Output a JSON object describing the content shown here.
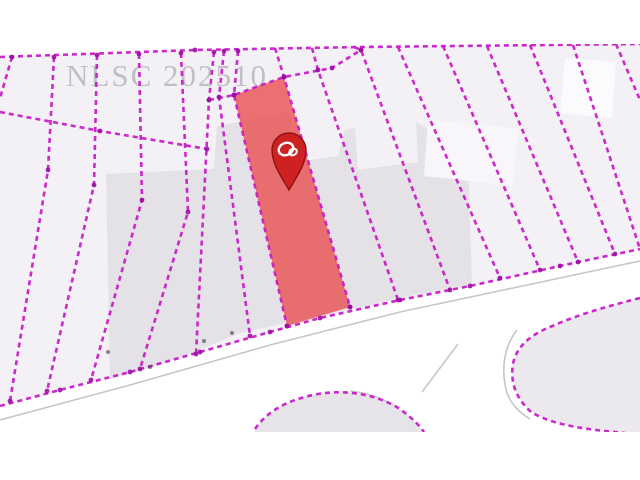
{
  "page": {
    "background": "#ffffff",
    "title": "Cadastral parcel map view"
  },
  "map": {
    "watermark": {
      "text": "NLSC 202510",
      "color": "#b7b5b9"
    },
    "colors": {
      "background": "#ffffff",
      "parcel_base_fill": "#f3f1f5",
      "parcel_gray_fill": "#e4e2e7",
      "road_edge": "#c7c5ca",
      "parcel_line": "#c81ec8",
      "vertex_dot": "#9a10a2",
      "highlight_fill": "#e94c4c",
      "pin_fill": "#ce2121",
      "pin_border": "#8e1111",
      "pin_logo": "#ffffff",
      "smudge": "#4a4350"
    },
    "area": {
      "left": 0,
      "top": 44,
      "right": 640,
      "bottom": 432
    },
    "line_style": {
      "width": 2.6,
      "dash": "5 4",
      "vertex_r": 2.4
    },
    "base_strip": [
      [
        0,
        57
      ],
      [
        195,
        50
      ],
      [
        360,
        47
      ],
      [
        640,
        44
      ],
      [
        640,
        249
      ],
      [
        560,
        266
      ],
      [
        470,
        286
      ],
      [
        400,
        300
      ],
      [
        320,
        318
      ],
      [
        270,
        332
      ],
      [
        200,
        352
      ],
      [
        130,
        372
      ],
      [
        60,
        390
      ],
      [
        0,
        406
      ]
    ],
    "gray_areas": [
      {
        "fill": "#e4e2e7",
        "points": [
          [
            106,
            174
          ],
          [
            214,
            169
          ],
          [
            217,
            126
          ],
          [
            290,
            112
          ],
          [
            292,
            163
          ],
          [
            338,
            156
          ],
          [
            345,
            130
          ],
          [
            355,
            128
          ],
          [
            358,
            170
          ],
          [
            418,
            162
          ],
          [
            416,
            122
          ],
          [
            448,
            140
          ],
          [
            468,
            158
          ],
          [
            472,
            284
          ],
          [
            400,
            298
          ],
          [
            320,
            316
          ],
          [
            240,
            333
          ],
          [
            196,
            351
          ],
          [
            160,
            365
          ],
          [
            110,
            379
          ]
        ]
      },
      {
        "fill": "#fbfafd",
        "points": [
          [
            565,
            58
          ],
          [
            616,
            62
          ],
          [
            612,
            118
          ],
          [
            560,
            113
          ]
        ]
      },
      {
        "fill": "#f8f6fa",
        "points": [
          [
            428,
            120
          ],
          [
            518,
            128
          ],
          [
            513,
            186
          ],
          [
            424,
            176
          ]
        ]
      }
    ],
    "boundary_lines": [
      {
        "name": "top-boundary",
        "points": [
          [
            0,
            57
          ],
          [
            195,
            50
          ],
          [
            360,
            47
          ],
          [
            640,
            44
          ]
        ]
      },
      {
        "name": "left-row-divider",
        "points": [
          [
            0,
            112
          ],
          [
            100,
            131
          ],
          [
            207,
            149
          ]
        ]
      },
      {
        "name": "mid-row-divider",
        "points": [
          [
            209,
            100
          ],
          [
            234,
            95
          ],
          [
            284,
            77
          ],
          [
            332,
            68
          ],
          [
            361,
            50
          ]
        ]
      },
      {
        "name": "road-front-boundary",
        "points": [
          [
            0,
            406
          ],
          [
            60,
            390
          ],
          [
            130,
            372
          ],
          [
            200,
            352
          ],
          [
            270,
            332
          ],
          [
            320,
            318
          ],
          [
            400,
            300
          ],
          [
            470,
            286
          ],
          [
            560,
            266
          ],
          [
            640,
            249
          ]
        ]
      },
      {
        "name": "lot-line",
        "points": [
          [
            12,
            57
          ],
          [
            0,
            98
          ]
        ]
      },
      {
        "name": "lot-line",
        "points": [
          [
            54,
            57
          ],
          [
            48,
            170
          ],
          [
            10,
            401
          ]
        ]
      },
      {
        "name": "lot-line",
        "points": [
          [
            97,
            55
          ],
          [
            94,
            185
          ],
          [
            47,
            391
          ]
        ]
      },
      {
        "name": "lot-line",
        "points": [
          [
            139,
            54
          ],
          [
            142,
            200
          ],
          [
            91,
            380
          ]
        ]
      },
      {
        "name": "lot-line",
        "points": [
          [
            181,
            53
          ],
          [
            188,
            212
          ],
          [
            140,
            369
          ]
        ]
      },
      {
        "name": "lot-line",
        "points": [
          [
            214,
            52
          ],
          [
            209,
            100
          ],
          [
            196,
            354
          ]
        ]
      },
      {
        "name": "lot-line",
        "points": [
          [
            224,
            51
          ],
          [
            219,
            97
          ],
          [
            250,
            336
          ]
        ]
      },
      {
        "name": "lot-line",
        "points": [
          [
            238,
            51
          ],
          [
            234,
            95
          ],
          [
            287,
            326
          ]
        ]
      },
      {
        "name": "lot-line",
        "points": [
          [
            275,
            48
          ],
          [
            284,
            77
          ],
          [
            350,
            307
          ]
        ]
      },
      {
        "name": "lot-line",
        "points": [
          [
            312,
            48
          ],
          [
            318,
            70
          ],
          [
            398,
            300
          ]
        ]
      },
      {
        "name": "lot-line",
        "points": [
          [
            354,
            47
          ],
          [
            361,
            50
          ],
          [
            450,
            290
          ]
        ]
      },
      {
        "name": "lot-line",
        "points": [
          [
            398,
            47
          ],
          [
            500,
            278
          ]
        ]
      },
      {
        "name": "lot-line",
        "points": [
          [
            443,
            46
          ],
          [
            540,
            270
          ]
        ]
      },
      {
        "name": "lot-line",
        "points": [
          [
            487,
            46
          ],
          [
            578,
            262
          ]
        ]
      },
      {
        "name": "lot-line",
        "points": [
          [
            530,
            45
          ],
          [
            615,
            254
          ]
        ]
      },
      {
        "name": "lot-line",
        "points": [
          [
            573,
            45
          ],
          [
            640,
            249
          ]
        ]
      },
      {
        "name": "lot-line",
        "points": [
          [
            616,
            44
          ],
          [
            640,
            100
          ]
        ]
      }
    ],
    "road_edges": [
      {
        "d": "M0,420 L130,385 L270,345 L400,312 L560,278 L640,261"
      },
      {
        "d": "M517,330 C503,348 501,372 507,393 C511,404 520,413 530,419"
      },
      {
        "d": "M350,391 C380,394 405,408 418,432"
      },
      {
        "d": "M458,344 L422,392"
      }
    ],
    "bottom_parcels": [
      {
        "name": "corner-parcel-right",
        "fill": "#ebe9ee",
        "fill_d": "M640,298 C600,308 575,316 550,327 C528,336 516,348 513,364 C510,382 516,398 530,411 C545,422 575,428 605,431 L625,433 L640,433 Z",
        "outline_d": "M640,298 C600,308 575,316 550,327 C528,336 516,348 513,364 C510,382 516,398 530,411 C545,422 575,428 605,431 L625,433"
      },
      {
        "name": "corner-parcel-middle",
        "fill": "#e6e4e9",
        "fill_d": "M255,429 C268,410 290,399 318,394 C348,389 378,395 400,409 C412,418 420,426 424,432 L424,433 L255,433 Z",
        "outline_d": "M255,429 C268,410 290,399 318,394 C348,389 378,395 400,409 C412,418 420,426 424,432"
      }
    ],
    "highlight_parcel": {
      "points": [
        [
          234,
          95
        ],
        [
          284,
          77
        ],
        [
          350,
          307
        ],
        [
          287,
          326
        ]
      ],
      "opacity": 0.78
    },
    "pin": {
      "cx": 289,
      "cy": 150,
      "r": 17,
      "tip_y": 190
    },
    "smudges": [
      [
        108,
        352
      ],
      [
        150,
        367
      ],
      [
        204,
        341
      ],
      [
        232,
        333
      ]
    ]
  }
}
